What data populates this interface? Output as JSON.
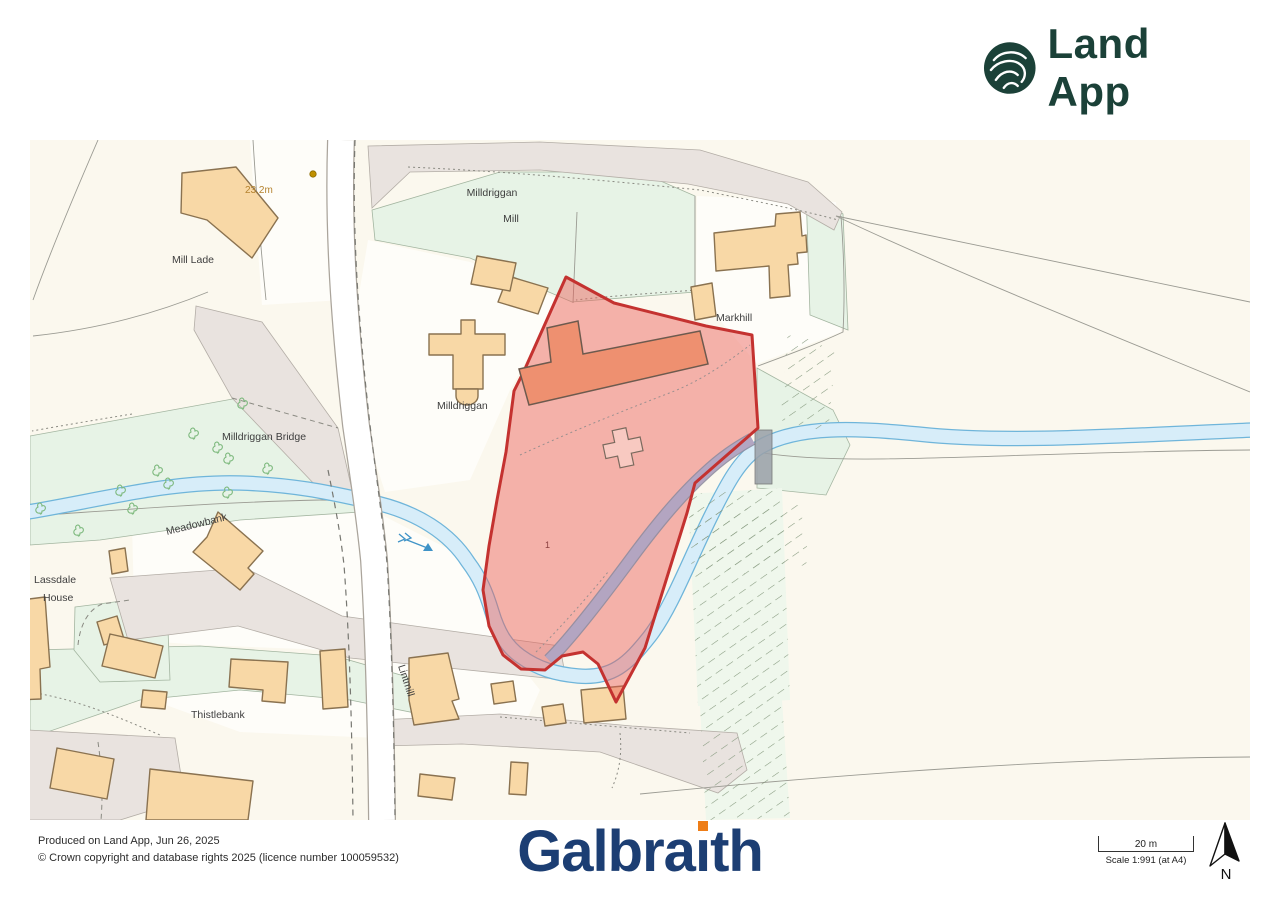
{
  "header": {
    "logo_text": "Land App",
    "logo_color": "#1b4138"
  },
  "map": {
    "labels": {
      "spot_height": "23.2m",
      "mill_lade": "Mill Lade",
      "milldriggan_mill_line1": "Milldriggan",
      "milldriggan_mill_line2": "Mill",
      "markhill": "Markhill",
      "milldriggan": "Milldriggan",
      "milldriggan_bridge": "Milldriggan Bridge",
      "meadowbank": "Meadowbank",
      "lassdale_line1": "Lassdale",
      "lassdale_line2": "House",
      "thistlebank": "Thistlebank",
      "lintmill": "Lintmill",
      "parcel_id": "1"
    },
    "colors": {
      "boundary_red": "#c43230",
      "boundary_fill": "rgba(235,90,85,0.45)",
      "building": "#f8d8a6",
      "mill_building": "#ee9070",
      "stream_fill": "#d7edf9",
      "stream_edge": "#6fb5da",
      "field_green": "#e7f3e6",
      "track_grey": "#e9e3df"
    }
  },
  "footer": {
    "produced_line": "Produced on Land App, Jun 26, 2025",
    "copyright_line": "© Crown copyright and database rights 2025 (licence number 100059532)",
    "galbraith": {
      "prefix": "Galbra",
      "dotless_i": "ı",
      "suffix": "th"
    },
    "scale_bar": {
      "distance_label": "20 m",
      "scale_label": "Scale 1:991 (at A4)"
    },
    "north_label": "N"
  }
}
